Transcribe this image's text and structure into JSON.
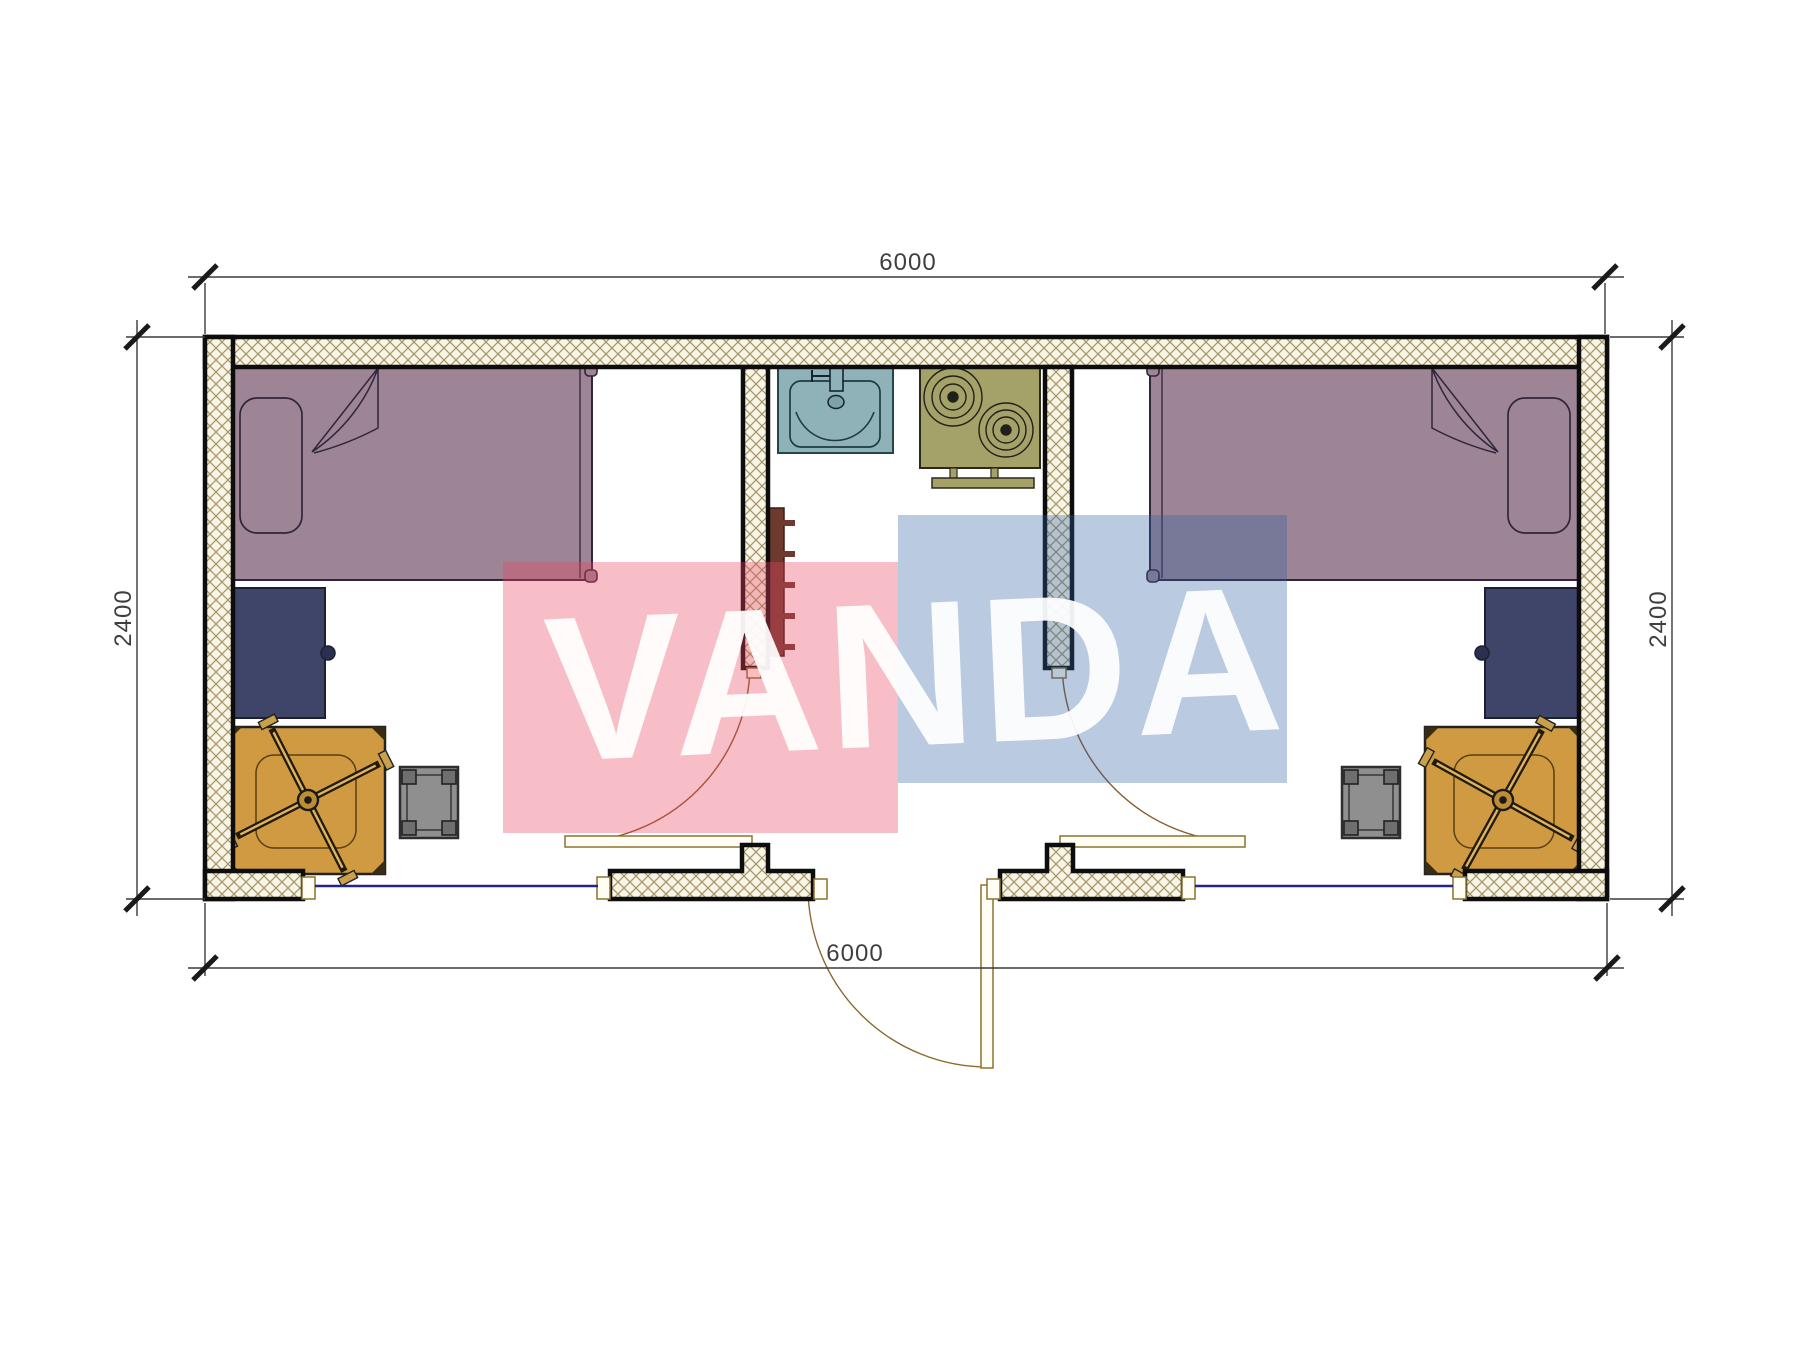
{
  "drawing": {
    "kind": "container-house-floor-plan",
    "dimensions": {
      "top_width_mm": "6000",
      "bottom_width_mm": "6000",
      "left_height_mm": "2400",
      "right_height_mm": "2400"
    },
    "watermark": {
      "text": "VANDA",
      "red_block_color": "#e94e65",
      "blue_block_color": "#2d5fa0"
    },
    "palette": {
      "wall_hatch_line": "#a39565",
      "wall_hatch_bg": "#f8f4e6",
      "wall_border": "#0d0d0d",
      "bed_fill": "#9d8596",
      "desk_navy_fill": "#3f4569",
      "desk_orange_fill": "#cf9a41",
      "stool_fill": "#8f8f8f",
      "sink_fill": "#8fb2b8",
      "stove_fill": "#a5a269",
      "radiator_fill": "#6e392f",
      "window_glass": "#23238c",
      "door_arc": "#8a5a28",
      "dimension_line": "#3a3a3a"
    },
    "elements": [
      "bed-left-icon",
      "bed-right-icon",
      "pillow-left-icon",
      "pillow-right-icon",
      "desk-left-icon",
      "desk-right-icon",
      "work-table-left-icon",
      "work-table-right-icon",
      "office-chair-left-icon",
      "office-chair-right-icon",
      "stool-left-icon",
      "stool-right-icon",
      "sink-icon",
      "stove-icon",
      "radiator-icon",
      "window-left-icon",
      "window-right-icon",
      "door-left-icon",
      "door-right-icon",
      "entry-door-icon"
    ]
  }
}
